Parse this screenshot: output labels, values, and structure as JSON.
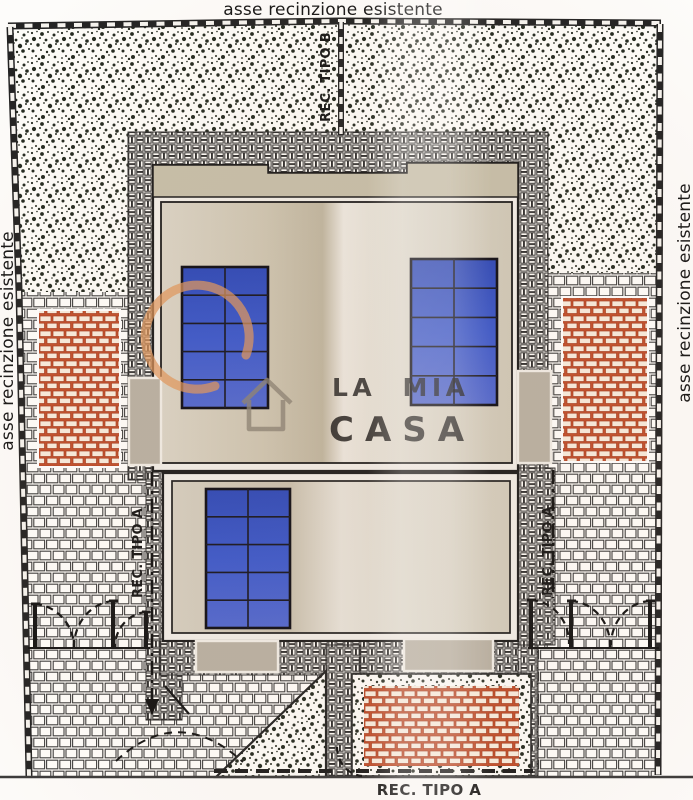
{
  "plan": {
    "boundary_labels": {
      "top": "asse recinzione esistente",
      "left": "asse recinzione esistente",
      "right": "asse recinzione esistente"
    },
    "fence_type_labels": {
      "type_b_top": "REC. TIPO B",
      "type_a_left": "REC. TIPO A",
      "type_a_right": "REC. TIPO A",
      "type_a_bottom": "REC. TIPO A"
    },
    "watermark": {
      "brand_top": "LA MIA",
      "brand_bottom": "CASA",
      "orange": "#e0975c",
      "gray": "#8b8375"
    },
    "colors": {
      "solar_panel_blue": "#3a57c8",
      "red_brick_mortar": "#c14f2b",
      "roof_beige": "#d6cfc0",
      "eaves_tan": "#c6bfa9",
      "porch_gray": "#b8b1a3",
      "ink": "#232323",
      "paper": "#fdfcfa"
    }
  }
}
